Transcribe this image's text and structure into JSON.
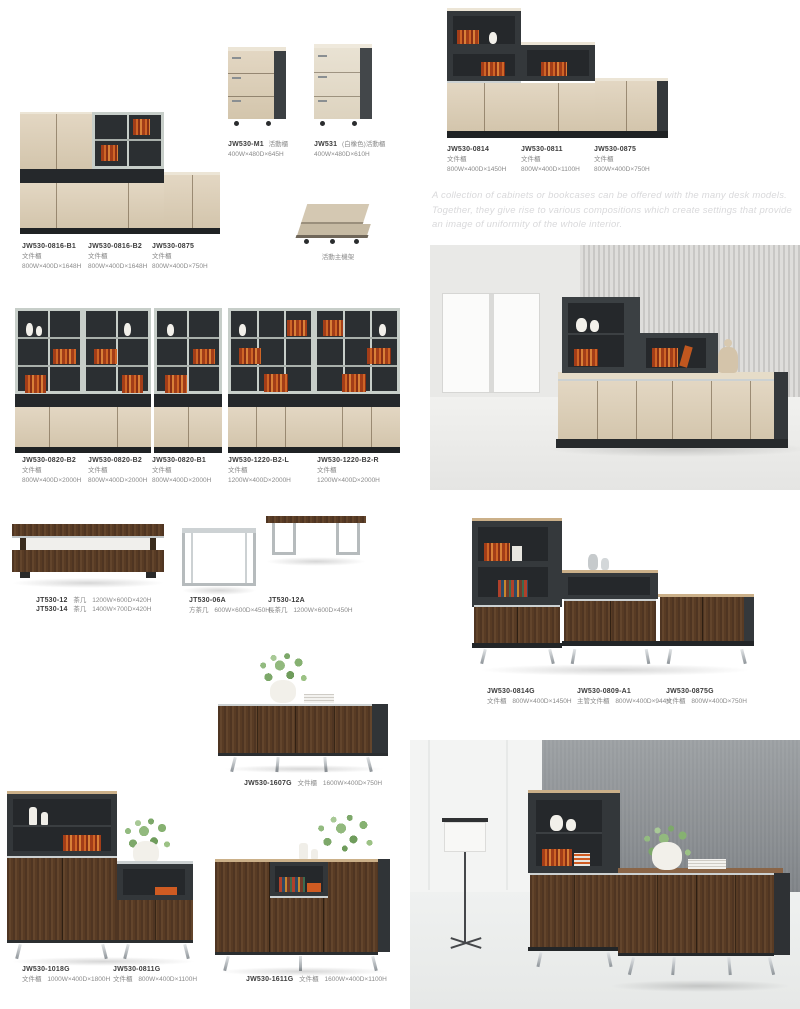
{
  "intro": {
    "text": "A collection of cabinets or bookcases can be offered with the many desk models. Together, they give rise to various compositions which create settings that provide an image of uniformity of the whole interior."
  },
  "labels": {
    "c0816b1": {
      "code": "JW530-0816-B1",
      "type": "文件櫃",
      "dims": "800W×400D×1648H"
    },
    "c0816b2": {
      "code": "JW530-0816-B2",
      "type": "文件櫃",
      "dims": "800W×400D×1648H"
    },
    "c0875": {
      "code": "JW530-0875",
      "type": "文件櫃",
      "dims": "800W×400D×750H"
    },
    "m1": {
      "code": "JW530-M1",
      "type": "活動櫃",
      "dims": "400W×480D×645H"
    },
    "j531": {
      "code": "JW531",
      "type": "(白橡色)活動櫃",
      "dims": "400W×480D×610H"
    },
    "cpu": {
      "type": "活動主機架"
    },
    "c0814": {
      "code": "JW530-0814",
      "type": "文件櫃",
      "dims": "800W×400D×1450H"
    },
    "c0811": {
      "code": "JW530-0811",
      "type": "文件櫃",
      "dims": "800W×400D×1100H"
    },
    "c0875b": {
      "code": "JW530-0875",
      "type": "文件櫃",
      "dims": "800W×400D×750H"
    },
    "c0820a": {
      "code": "JW530-0820-B2",
      "type": "文件櫃",
      "dims": "800W×400D×2000H"
    },
    "c0820b": {
      "code": "JW530-0820-B2",
      "type": "文件櫃",
      "dims": "800W×400D×2000H"
    },
    "c0820c": {
      "code": "JW530-0820-B1",
      "type": "文件櫃",
      "dims": "800W×400D×2000H"
    },
    "c1220l": {
      "code": "JW530-1220-B2-L",
      "type": "文件櫃",
      "dims": "1200W×400D×2000H"
    },
    "c1220r": {
      "code": "JW530-1220-B2-R",
      "type": "文件櫃",
      "dims": "1200W×400D×2000H"
    },
    "t12": {
      "code": "JT530-12",
      "type": "茶几",
      "dims": "1200W×600D×420H"
    },
    "t14": {
      "code": "JT530-14",
      "type": "茶几",
      "dims": "1400W×700D×420H"
    },
    "t06a": {
      "code": "JT530-06A",
      "type": "方茶几",
      "dims": "600W×600D×450H"
    },
    "t12a": {
      "code": "JT530-12A",
      "type": "長茶几",
      "dims": "1200W×600D×450H"
    },
    "c0814g": {
      "code": "JW530-0814G",
      "type": "文件櫃",
      "dims": "800W×400D×1450H"
    },
    "c0809a1": {
      "code": "JW530-0809-A1",
      "type": "主管文件櫃",
      "dims": "800W×400D×944H"
    },
    "c0875g": {
      "code": "JW530-0875G",
      "type": "文件櫃",
      "dims": "800W×400D×750H"
    },
    "c1607g": {
      "code": "JW530-1607G",
      "type": "文件櫃",
      "dims": "1600W×400D×750H"
    },
    "c1018g": {
      "code": "JW530-1018G",
      "type": "文件櫃",
      "dims": "1000W×400D×1800H"
    },
    "c0811g": {
      "code": "JW530-0811G",
      "type": "文件櫃",
      "dims": "800W×400D×1100H"
    },
    "c1611g": {
      "code": "JW530-1611G",
      "type": "文件櫃",
      "dims": "1600W×400D×1100H"
    }
  },
  "colors": {
    "maple_wood": "#d9cbb4",
    "anthracite": "#34383b",
    "walnut": "#5d3f28",
    "chrome": "#b6bbbe",
    "book_orange": "#cf6526",
    "intro_gray": "#d9d9db"
  }
}
